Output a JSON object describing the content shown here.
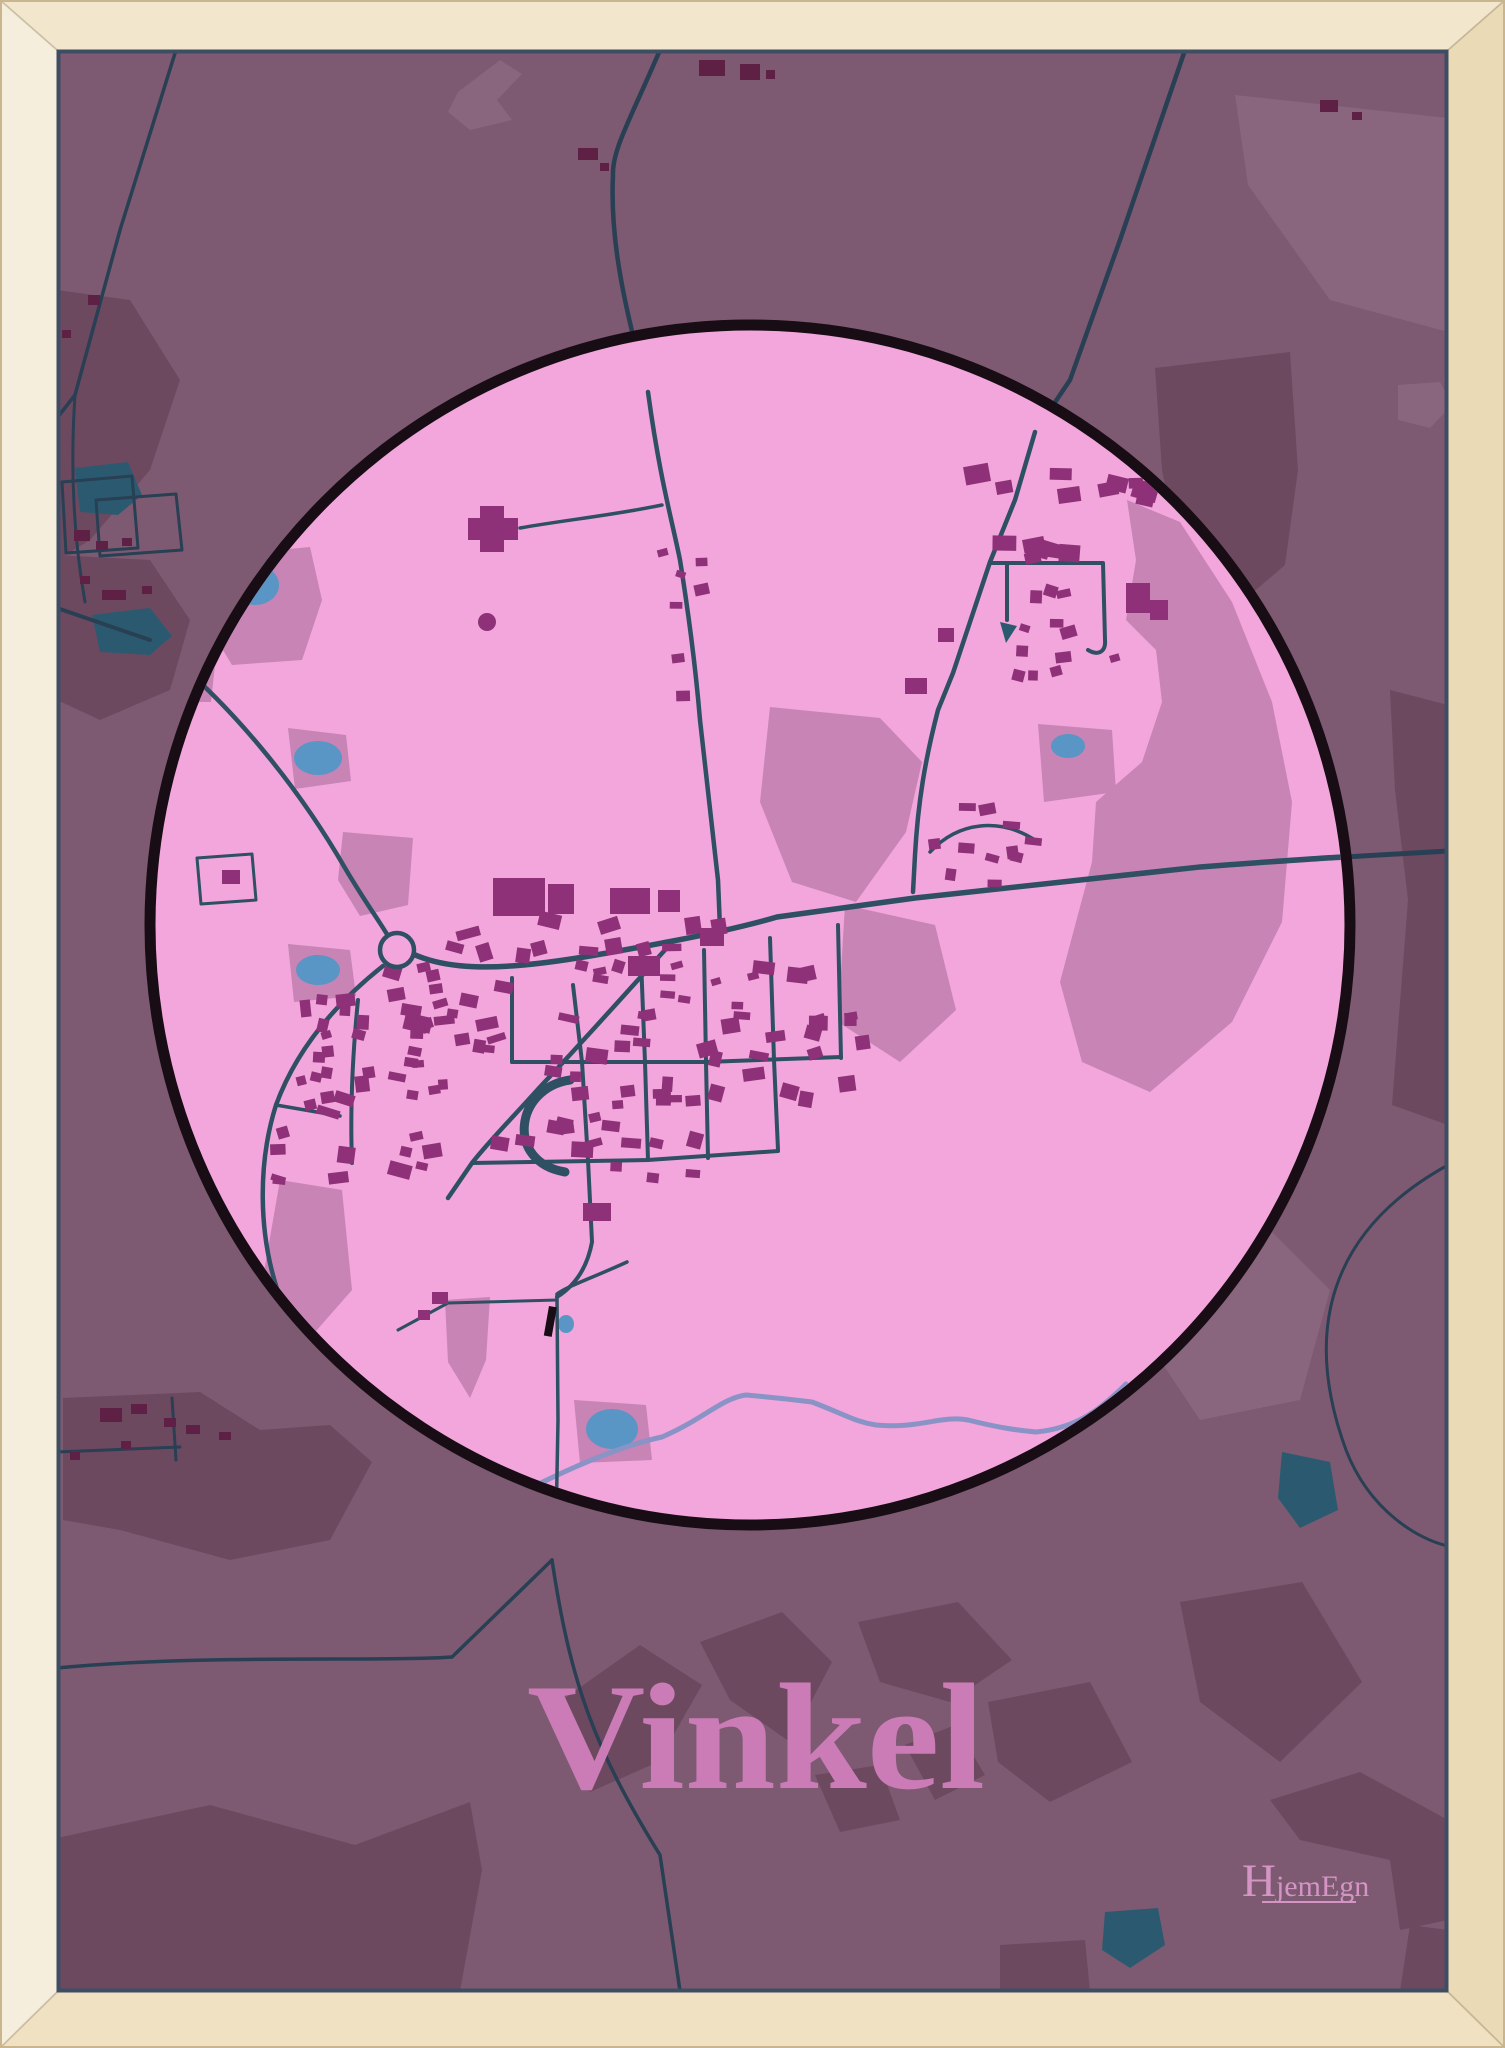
{
  "poster": {
    "title": "Vinkel",
    "brand_initial": "H",
    "brand_rest": "jemEgn"
  },
  "colors": {
    "bg": "#7d5a71",
    "patch_dark": "#6d4960",
    "patch_light": "#8a657e",
    "circle": "#f2a6dc",
    "ring": "#190d15",
    "mauve": "#c784b5",
    "b_in": "#8e3178",
    "b_out": "#5e2145",
    "road_in": "#2f4f63",
    "road_out": "#283f54",
    "pond": "#5995c5",
    "lake": "#2b5a70",
    "river": "#8a93c6",
    "title": "#cb7cb7",
    "brand": "#d495c5",
    "frame_top": "#f2e6cd",
    "frame_left": "#f6eedd",
    "frame_right": "#eadab6",
    "frame_bottom": "#efe1c2",
    "frame_edge": "#c9b68e",
    "frame_shadow": "#3d4d63"
  },
  "map": {
    "width": 1505,
    "height": 2048,
    "inset": {
      "left": 57,
      "top": 50,
      "right": 57,
      "bottom": 56
    },
    "circle": {
      "cx": 750,
      "cy": 925,
      "r": 600,
      "ring": 11
    },
    "outer_patches": [
      {
        "shade": "dark",
        "pts": "57,290 130,300 180,380 150,470 90,540 57,560"
      },
      {
        "shade": "dark",
        "pts": "57,555 150,560 190,620 170,690 100,720 57,700"
      },
      {
        "shade": "dark",
        "pts": "1155,368 1290,352 1298,470 1285,565 1230,612 1180,560 1162,470"
      },
      {
        "shade": "dark",
        "pts": "1390,690 1448,705 1448,1125 1392,1105 1408,900 1395,790"
      },
      {
        "shade": "light",
        "pts": "448,112 458,92 500,60 522,74 497,100 512,120 470,130"
      },
      {
        "shade": "light",
        "pts": "1235,95 1448,118 1448,332 1330,300 1248,185"
      },
      {
        "shade": "light",
        "pts": "1398,385 1440,382 1452,405 1430,428 1398,420"
      },
      {
        "shade": "light",
        "pts": "1150,1240 1260,1220 1330,1290 1300,1400 1200,1420 1140,1330"
      },
      {
        "shade": "dark",
        "pts": "63,1398 200,1392 260,1430 330,1425 372,1462 330,1540 230,1560 120,1530 63,1520"
      },
      {
        "shade": "dark",
        "pts": "555,1705 640,1645 702,1685 658,1762 590,1792"
      },
      {
        "shade": "dark",
        "pts": "700,1642 782,1612 832,1662 790,1742 730,1700"
      },
      {
        "shade": "dark",
        "pts": "858,1622 958,1602 1012,1660 950,1702 880,1682"
      },
      {
        "shade": "dark",
        "pts": "988,1702 1090,1682 1132,1762 1050,1802 998,1762"
      },
      {
        "shade": "dark",
        "pts": "1180,1602 1302,1582 1362,1682 1280,1762 1200,1702"
      },
      {
        "shade": "dark",
        "pts": "905,1745 955,1725 985,1775 935,1800"
      },
      {
        "shade": "dark",
        "pts": "815,1775 880,1765 900,1820 840,1832"
      },
      {
        "shade": "dark",
        "pts": "57,1838 210,1805 355,1845 470,1802 482,1870 460,1991 57,1991"
      },
      {
        "shade": "dark",
        "pts": "1270,1800 1360,1772 1448,1820 1448,1920 1400,1930 1390,1860 1300,1840"
      },
      {
        "shade": "dark",
        "pts": "1410,1925 1448,1930 1448,1991 1400,1991"
      },
      {
        "shade": "dark",
        "pts": "1000,1945 1085,1940 1090,1991 1000,1991"
      }
    ],
    "outer_lakes": [
      "75,468 128,462 142,495 118,515 80,512",
      "92,615 150,608 172,636 150,655 100,652",
      "1282,1452 1330,1462 1338,1510 1300,1528 1278,1498",
      "1105,1912 1158,1908 1165,1945 1130,1968 1102,1950"
    ],
    "outer_roads": [
      {
        "d": "M176,50 L120,230 L75,395 L57,418",
        "w": 3.5
      },
      {
        "d": "M75,395 C70,470 74,540 85,602",
        "w": 3
      },
      {
        "d": "M57,608 L150,640",
        "w": 4
      },
      {
        "d": "M660,50 C630,120 612,150 613,175 C610,235 622,300 648,392",
        "w": 4.5
      },
      {
        "d": "M1185,50 L1120,240 L1070,380 L1035,432",
        "w": 4.5
      },
      {
        "d": "M1345,857 L1448,851",
        "w": 5
      },
      {
        "d": "M57,1668 C200,1654 380,1662 452,1657 L552,1560",
        "w": 3.5
      },
      {
        "d": "M552,1560 C570,1680 593,1747 660,1855 L680,1991",
        "w": 3.5
      },
      {
        "d": "M57,1452 L180,1447",
        "w": 3
      },
      {
        "d": "M172,1398 L176,1460",
        "w": 3
      },
      {
        "d": "M1448,1165 C1330,1230 1302,1330 1346,1450 C1370,1512 1420,1540 1448,1546",
        "w": 3
      },
      {
        "d": "M62,482 L132,476 L138,548 L66,553 Z",
        "w": 3
      },
      {
        "d": "M96,500 L176,494 L182,550 L100,556 Z",
        "w": 3
      }
    ],
    "outer_buildings": [
      [
        699,
        60,
        26,
        16
      ],
      [
        740,
        64,
        20,
        16
      ],
      [
        766,
        70,
        9,
        9
      ],
      [
        578,
        148,
        20,
        12
      ],
      [
        600,
        163,
        9,
        8
      ],
      [
        88,
        295,
        12,
        10
      ],
      [
        62,
        330,
        9,
        8
      ],
      [
        74,
        530,
        16,
        11
      ],
      [
        96,
        541,
        12,
        9
      ],
      [
        122,
        538,
        10,
        8
      ],
      [
        80,
        576,
        10,
        8
      ],
      [
        102,
        590,
        24,
        10
      ],
      [
        142,
        586,
        10,
        8
      ],
      [
        100,
        1408,
        22,
        14
      ],
      [
        131,
        1404,
        16,
        10
      ],
      [
        164,
        1418,
        12,
        9
      ],
      [
        121,
        1441,
        10,
        8
      ],
      [
        186,
        1425,
        14,
        9
      ],
      [
        70,
        1452,
        10,
        8
      ],
      [
        219,
        1432,
        12,
        8
      ],
      [
        1320,
        100,
        18,
        12
      ],
      [
        1352,
        112,
        10,
        8
      ]
    ],
    "inner_patches": [
      "205,557 310,547 322,600 302,660 232,665 200,612",
      "152,650 216,655 211,702 156,702",
      "770,707 880,718 922,762 906,832 856,902 792,882 760,802",
      "845,905 935,925 956,1010 900,1062 838,1022",
      "1127,500 1180,522 1232,602 1272,702 1292,802 1282,922 1232,1022 1150,1092 1082,1062 1060,982 1092,862 1096,802 1142,762 1162,702 1156,650 1126,620 1136,560",
      "1038,724 1112,730 1116,792 1044,802",
      "280,1180 342,1190 352,1290 302,1347 264,1272",
      "288,944 350,950 356,996 294,1002",
      "445,1300 490,1297 486,1360 470,1398 448,1362",
      "343,832 413,838 408,905 360,916 338,880",
      "288,728 346,735 351,781 295,789",
      "574,1400 646,1405 652,1460 580,1463"
    ],
    "ponds": [
      {
        "cx": 255,
        "cy": 585,
        "rx": 24,
        "ry": 20
      },
      {
        "cx": 318,
        "cy": 758,
        "rx": 24,
        "ry": 17
      },
      {
        "cx": 1068,
        "cy": 746,
        "rx": 17,
        "ry": 12
      },
      {
        "cx": 566,
        "cy": 1324,
        "rx": 8,
        "ry": 9
      },
      {
        "cx": 318,
        "cy": 970,
        "rx": 22,
        "ry": 15
      },
      {
        "cx": 612,
        "cy": 1429,
        "rx": 26,
        "ry": 20
      }
    ],
    "triangle_pond": "1000,622 1017,626 1006,643",
    "river": {
      "d": "M470,1520 C560,1470 620,1446 662,1437 C702,1420 722,1398 746,1395 C780,1398 796,1400 812,1402 C846,1415 856,1422 876,1425 C920,1429 941,1415 968,1420 C1000,1428 1016,1430 1036,1432 C1078,1428 1102,1408 1126,1384",
      "w": 5
    },
    "inner_roads": [
      {
        "d": "M150,640 C230,700 300,790 345,868 C365,902 382,925 388,936",
        "w": 4.5
      },
      {
        "d": "M383,966 C340,1000 298,1045 276,1105 C258,1162 258,1232 278,1292 C290,1326 305,1352 318,1374",
        "w": 4.5
      },
      {
        "d": "M413,954 C470,980 560,962 673,941 C730,930 760,922 777,917 C840,908 880,903 915,898 C1000,888 1100,877 1200,867 C1280,861 1320,858 1345,857",
        "w": 5.5
      },
      {
        "d": "M648,392 C660,480 672,520 680,560 C688,610 695,660 700,720 C707,780 712,830 718,880 L720,928",
        "w": 4.5
      },
      {
        "d": "M1035,432 L1015,500 L990,562 L953,673 L938,710 C925,760 918,802 915,855 L913,892",
        "w": 4.5
      },
      {
        "d": "M990,563 L1103,563 L1105,640 C1106,652 1098,656 1088,650",
        "w": 4
      },
      {
        "d": "M1007,565 L1007,620",
        "w": 4
      },
      {
        "d": "M662,505 C615,515 565,520 520,528",
        "w": 3.5
      },
      {
        "d": "M673,941 C620,1000 575,1050 540,1087 C515,1115 490,1140 472,1163 L448,1198",
        "w": 4.5
      },
      {
        "d": "M512,978 L512,1062",
        "w": 4
      },
      {
        "d": "M573,985 L582,1062 L588,1160",
        "w": 4
      },
      {
        "d": "M641,960 L645,1062 L648,1160",
        "w": 4
      },
      {
        "d": "M704,950 L706,1062 L708,1158",
        "w": 4
      },
      {
        "d": "M770,938 L774,1060 L778,1150",
        "w": 4
      },
      {
        "d": "M838,925 L841,1058",
        "w": 4
      },
      {
        "d": "M512,1062 L706,1062 L841,1057",
        "w": 4
      },
      {
        "d": "M472,1163 L648,1160 L778,1151",
        "w": 4
      },
      {
        "d": "M358,1000 C352,1060 350,1110 352,1163",
        "w": 4
      },
      {
        "d": "M276,1105 L340,1116",
        "w": 3.5
      },
      {
        "d": "M570,1080 C515,1088 505,1162 565,1172",
        "w": 9
      },
      {
        "d": "M588,1160 L592,1242 C586,1275 568,1290 557,1297",
        "w": 4
      },
      {
        "d": "M627,1262 C592,1278 568,1286 557,1294 L557,1300 L558,1420 L556,1527",
        "w": 3.5
      },
      {
        "d": "M557,1300 L448,1303 L398,1330",
        "w": 3
      },
      {
        "d": "M930,852 C958,822 1000,816 1038,842",
        "w": 3.5
      },
      {
        "d": "M197,858 L252,854 L256,900 L201,904 Z",
        "w": 3
      }
    ],
    "roundabout": {
      "cx": 397,
      "cy": 950,
      "r": 17,
      "w": 4.5
    },
    "dot_building": {
      "cx": 487,
      "cy": 622,
      "r": 9
    },
    "cross_building": "480,506 504,506 504,518 518,518 518,540 504,540 504,552 480,552 480,540 468,540 468,518 480,518",
    "dark_dash": {
      "x": 549,
      "y": 1306,
      "w": 8,
      "h": 30,
      "rot": 10
    },
    "building_clusters": [
      [
        375,
        1075,
        70,
        105,
        30,
        1,
        10,
        24
      ],
      [
        303,
        1105,
        28,
        80,
        10,
        2,
        9,
        16
      ],
      [
        560,
        1062,
        92,
        90,
        26,
        3,
        10,
        22
      ],
      [
        762,
        1048,
        105,
        95,
        26,
        4,
        10,
        22
      ],
      [
        585,
        935,
        155,
        26,
        14,
        5,
        10,
        24
      ],
      [
        1056,
        486,
        92,
        12,
        9,
        6,
        14,
        26
      ],
      [
        1063,
        551,
        60,
        9,
        7,
        7,
        14,
        24
      ],
      [
        1062,
        638,
        58,
        52,
        12,
        8,
        9,
        18
      ],
      [
        988,
        845,
        62,
        42,
        11,
        9,
        9,
        18
      ],
      [
        683,
        625,
        22,
        85,
        7,
        10,
        9,
        16
      ],
      [
        655,
        1140,
        55,
        55,
        9,
        11,
        9,
        16
      ],
      [
        450,
        1035,
        40,
        70,
        12,
        12,
        9,
        16
      ],
      [
        700,
        990,
        120,
        30,
        12,
        13,
        9,
        18
      ]
    ],
    "fixed_buildings": [
      [
        493,
        878,
        52,
        38
      ],
      [
        548,
        884,
        26,
        30
      ],
      [
        610,
        888,
        40,
        26
      ],
      [
        658,
        890,
        22,
        22
      ],
      [
        628,
        956,
        32,
        20
      ],
      [
        700,
        928,
        24,
        18
      ],
      [
        905,
        678,
        22,
        16
      ],
      [
        938,
        628,
        16,
        14
      ],
      [
        1126,
        583,
        24,
        30
      ],
      [
        1150,
        600,
        18,
        20
      ],
      [
        583,
        1203,
        28,
        18
      ],
      [
        432,
        1292,
        16,
        12
      ],
      [
        418,
        1310,
        12,
        10
      ],
      [
        222,
        870,
        18,
        14
      ]
    ],
    "title_pos": {
      "x": 756,
      "y": 1788,
      "size": 152,
      "length": 458
    },
    "brand_pos": {
      "x": 1242,
      "y": 1896,
      "size_h": 47,
      "size_rest": 30,
      "ul_x1": 1262,
      "ul_x2": 1356,
      "ul_y": 1902
    }
  }
}
